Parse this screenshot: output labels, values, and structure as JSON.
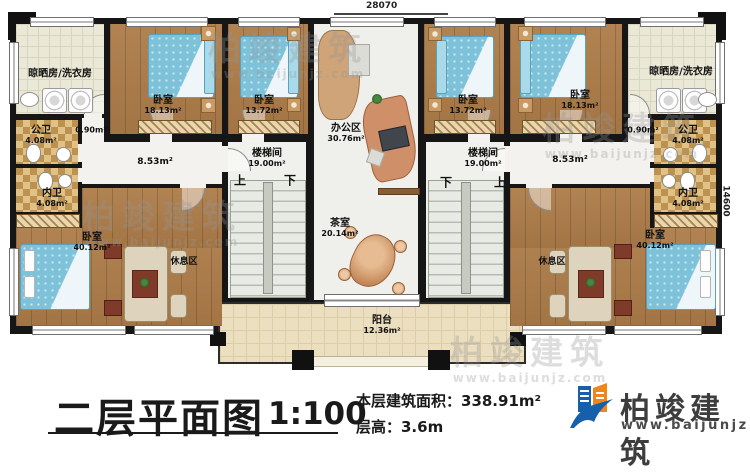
{
  "dimensions": {
    "top_width": "28070",
    "right_height": "14600"
  },
  "stair_labels": {
    "up": "上",
    "down": "下"
  },
  "rooms": {
    "laundry_left": {
      "name": "晾晒房/洗衣房"
    },
    "laundry_right": {
      "name": "晾晒房/洗衣房"
    },
    "bedroom_18_left": {
      "name": "卧室",
      "area": "18.13m²"
    },
    "bedroom_13_left": {
      "name": "卧室",
      "area": "13.72m²"
    },
    "bedroom_13_right": {
      "name": "卧室",
      "area": "13.72m²"
    },
    "bedroom_18_right": {
      "name": "卧室",
      "area": "18.13m²"
    },
    "office": {
      "name": "办公区",
      "area": "30.76m²"
    },
    "public_bath_left": {
      "name": "公卫",
      "area": "4.08m²"
    },
    "inner_bath_left": {
      "name": "内卫",
      "area": "4.08m²"
    },
    "public_bath_right": {
      "name": "公卫",
      "area": "4.08m²"
    },
    "inner_bath_right": {
      "name": "内卫",
      "area": "4.08m²"
    },
    "vestibule_left": {
      "area": "0.90m²"
    },
    "vestibule_right": {
      "area": "0.90m²"
    },
    "hall_left": {
      "area": "8.53m²"
    },
    "hall_right": {
      "area": "8.53m²"
    },
    "stairwell_left": {
      "name": "楼梯间",
      "area": "19.00m²"
    },
    "stairwell_right": {
      "name": "楼梯间",
      "area": "19.00m²"
    },
    "tearoom": {
      "name": "茶室",
      "area": "20.14m²"
    },
    "bedroom_master_left": {
      "name": "卧室",
      "area": "40.12m²"
    },
    "bedroom_master_right": {
      "name": "卧室",
      "area": "40.12m²"
    },
    "rest_area_left": {
      "name": "休息区"
    },
    "rest_area_right": {
      "name": "休息区"
    },
    "balcony": {
      "name": "阳台",
      "area": "12.36m²"
    }
  },
  "title_block": {
    "plan_name": "二层平面图",
    "scale": "1:100",
    "floor_area": "本层建筑面积：338.91m²",
    "floor_height": "层高：3.6m",
    "brand": "柏竣建筑",
    "brand_url": "www.baijunjz.com"
  },
  "watermark": {
    "brand": "柏竣建筑",
    "url": "www.baijunjz.com"
  },
  "colors": {
    "wall": "#161616",
    "wood_floor": "#ad7c49",
    "bed_blue": "#7ec2da",
    "bath_tile": "#bd9251",
    "balcony_tile": "#ecdfc0",
    "logo_blue": "#1660ab",
    "logo_orange": "#f08519"
  }
}
